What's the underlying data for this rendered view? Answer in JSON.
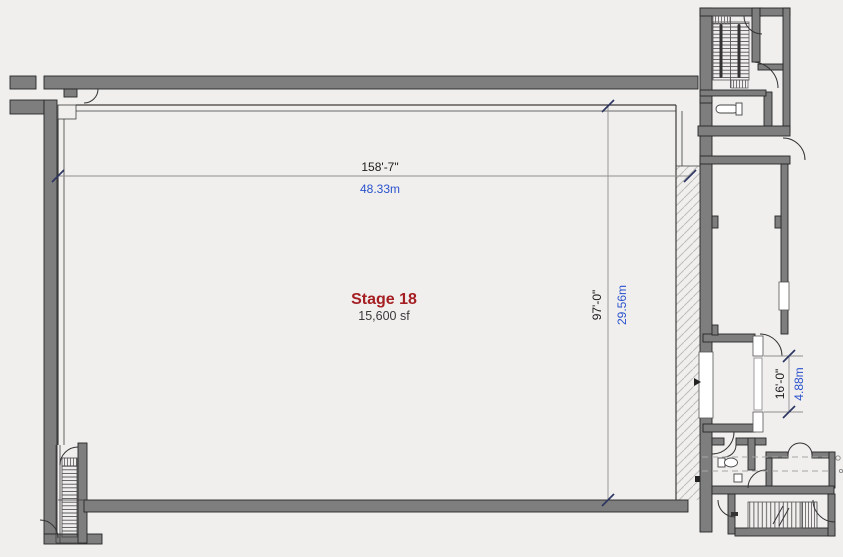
{
  "title": "Stage 18 Floor Plan",
  "stage": {
    "name": "Stage 18",
    "area": "15,600 sf"
  },
  "dimensions": {
    "width": {
      "imperial": "158'-7\"",
      "metric": "48.33m"
    },
    "height": {
      "imperial": "97'-0\"",
      "metric": "29.56m"
    },
    "elephant_door": {
      "imperial": "16'-0\"",
      "metric": "4.88m"
    }
  },
  "colors": {
    "background": "#f0efee",
    "wall-fill": "#7e7e7e",
    "wall-outline": "#262626",
    "thin-wall": "#3c3c3c",
    "hatch-line": "#bcbcba",
    "dimension-line": "#8f8f8f",
    "tick": "#2e3560",
    "imperial-text": "#1c1c1c",
    "metric-text": "#2a52cc",
    "stage-name": "#a51e22",
    "area-text": "#3a3a3a"
  }
}
